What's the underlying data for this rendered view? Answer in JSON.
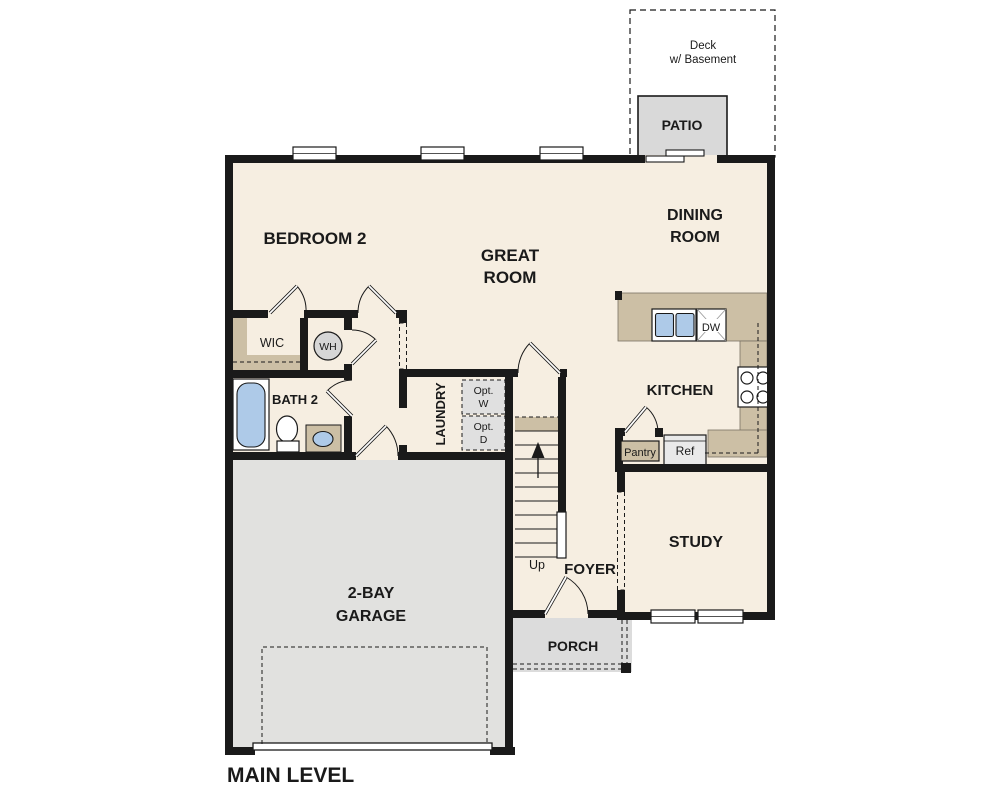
{
  "plan": {
    "title": "MAIN LEVEL",
    "type": "floor-plan"
  },
  "rooms": {
    "bedroom2": {
      "label": "BEDROOM 2"
    },
    "great": {
      "line1": "GREAT",
      "line2": "ROOM"
    },
    "dining": {
      "line1": "DINING",
      "line2": "ROOM"
    },
    "kitchen": {
      "label": "KITCHEN"
    },
    "study": {
      "label": "STUDY"
    },
    "foyer": {
      "label": "FOYER"
    },
    "laundry": {
      "label": "LAUNDRY"
    },
    "bath2": {
      "label": "BATH 2"
    },
    "wic": {
      "label": "WIC"
    },
    "garage": {
      "line1": "2-BAY",
      "line2": "GARAGE"
    },
    "porch": {
      "label": "PORCH"
    },
    "patio": {
      "label": "PATIO"
    },
    "deck": {
      "line1": "Deck",
      "line2": "w/ Basement"
    }
  },
  "fixtures": {
    "water_heater": "WH",
    "dishwasher": "DW",
    "refrigerator": "Ref",
    "pantry": "Pantry",
    "opt_washer": {
      "line1": "Opt.",
      "line2": "W"
    },
    "opt_dryer": {
      "line1": "Opt.",
      "line2": "D"
    },
    "stairs_up": "Up"
  },
  "colors": {
    "floor_cream": "#f6eee1",
    "counter_tan": "#ccbfa5",
    "garage_gray": "#e1e1df",
    "porch_gray": "#dcdcdc",
    "patio_gray": "#d9d9d9",
    "wall_black": "#1a1a1a",
    "fixture_blue": "#aecae8"
  }
}
